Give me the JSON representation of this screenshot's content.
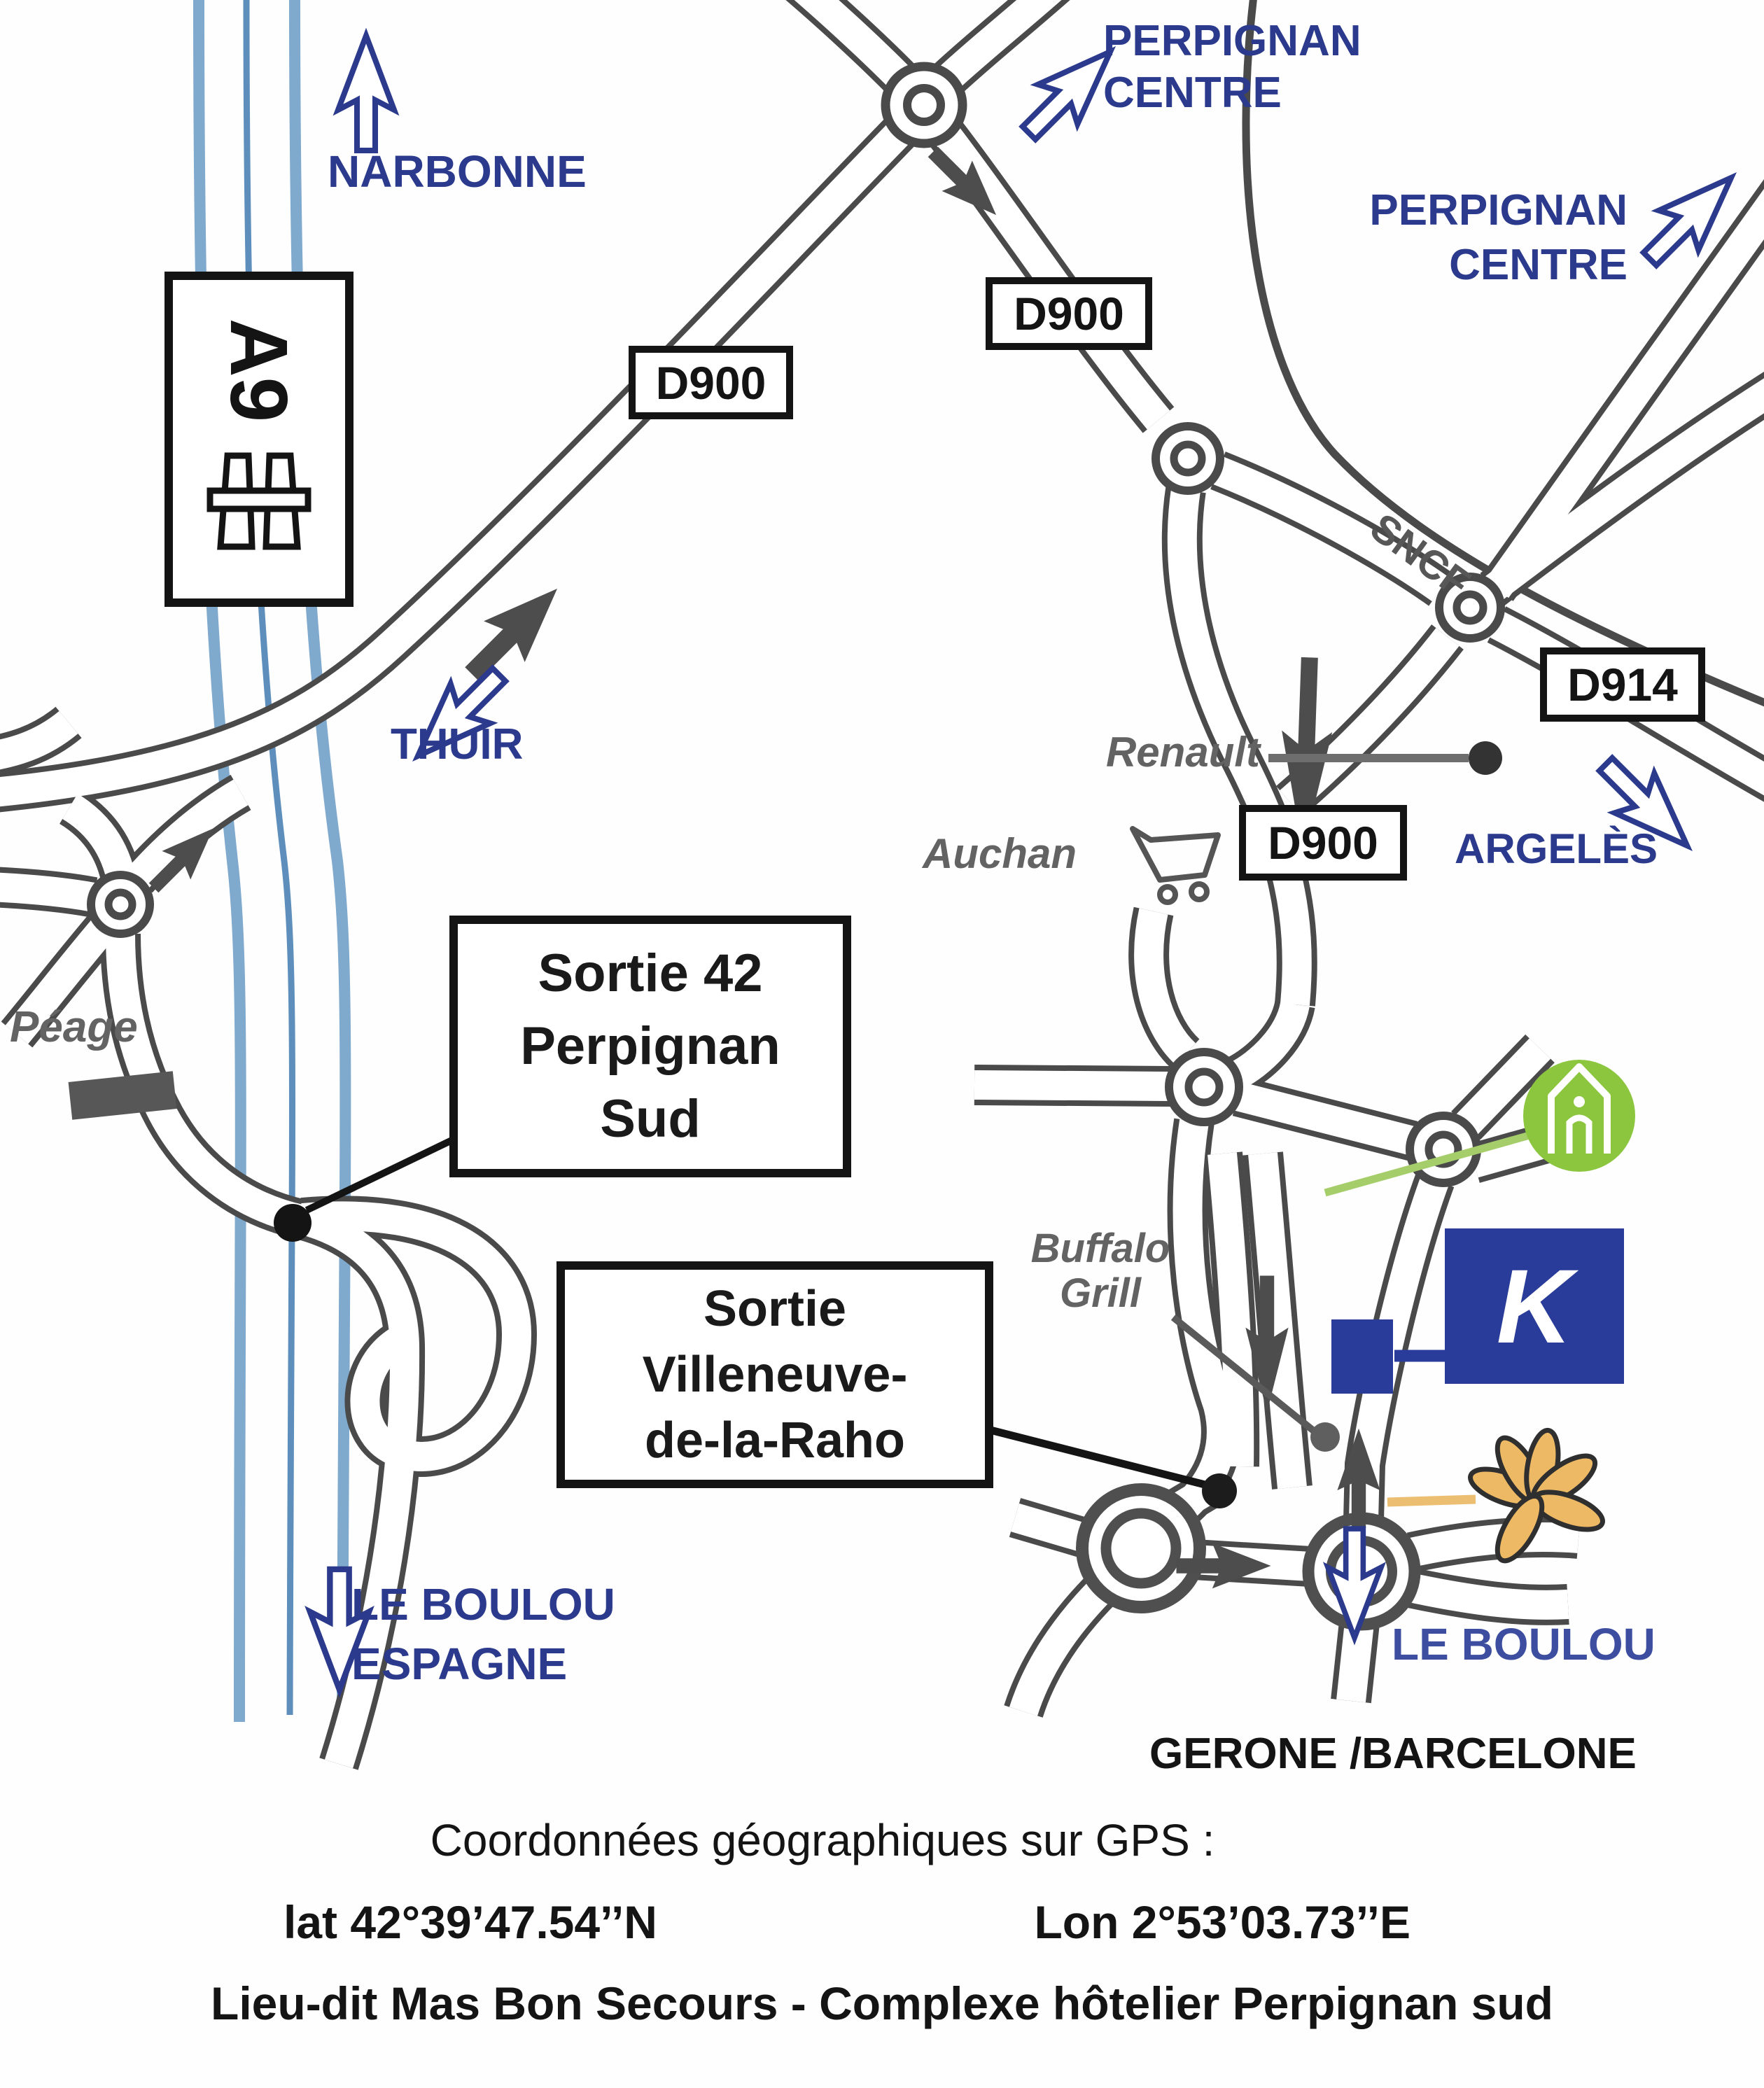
{
  "labels": {
    "narbonne": "NARBONNE",
    "perpignan_centre_l1": "PERPIGNAN",
    "perpignan_centre_l2": "CENTRE",
    "thuir": "THUIR",
    "argeles": "ARGELÈS",
    "sncf": "SNCF",
    "renault": "Renault",
    "auchan": "Auchan",
    "peage": "Péage",
    "buffalo_l1": "Buffalo",
    "buffalo_l2": "Grill",
    "le_boulou": "LE BOULOU",
    "espagne": "ESPAGNE",
    "le_boulou_right": "LE BOULOU",
    "gerone_barcelone": "GERONE /BARCELONE",
    "k_logo": "K"
  },
  "signs": {
    "a9": "A9",
    "d900": "D900",
    "d914": "D914"
  },
  "exits": {
    "sortie42": {
      "l1": "Sortie 42",
      "l2": "Perpignan",
      "l3": "Sud"
    },
    "villeneuve": {
      "l1": "Sortie",
      "l2": "Villeneuve-",
      "l3": "de-la-Raho"
    }
  },
  "footer": {
    "gps_heading": "Coordonnées géographiques sur GPS :",
    "lat": "lat 42°39’47.54’’N",
    "lon": "Lon 2°53’03.73’’E",
    "address": "Lieu-dit Mas Bon Secours - Complexe hôtelier Perpignan sud"
  },
  "icons": {
    "motorway": "motorway-bridge-icon",
    "cart": "shopping-cart-icon",
    "house": "green-house-hotel-icon",
    "flower": "orange-flower-icon",
    "k_square": "kyriad-k-logo"
  },
  "colors": {
    "navy_text": "#2B3A8C",
    "le_boulou_right": "#3D4DA0",
    "road_casing": "#4a4a4a",
    "motorway_blue": "#7FA9CD",
    "gray_text": "#636363",
    "k_blue": "#2A3C99",
    "green_icon": "#8CC63F",
    "flower_orange": "#EEB964"
  }
}
